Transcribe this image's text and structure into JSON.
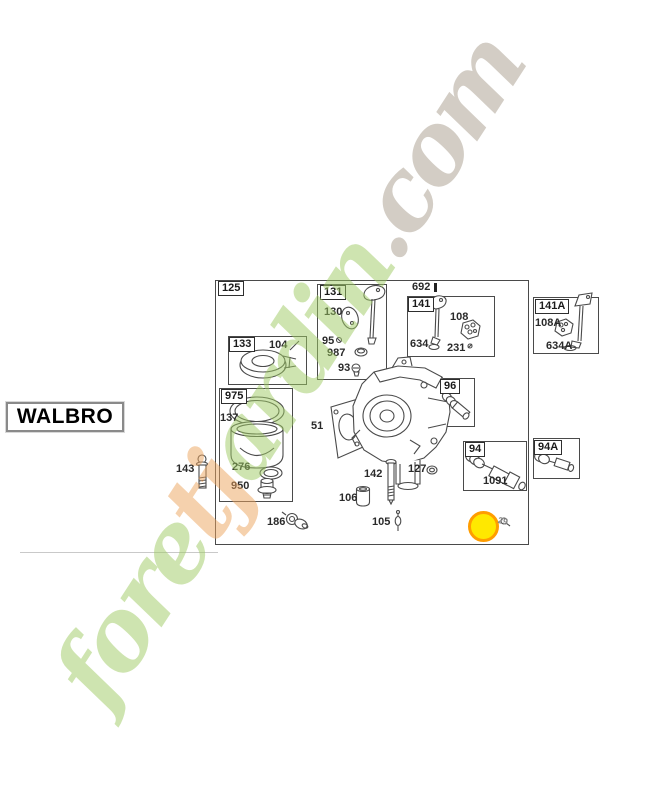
{
  "theme": {
    "green": "#9fcb63",
    "orange": "#eda45e",
    "tan": "#a89d8d",
    "highlight-fill": "#ffe800",
    "highlight-border": "#ff9d00",
    "line": "#4a4a4a"
  },
  "brand": {
    "text": "WALBRO"
  },
  "watermark": {
    "full_text": "foretjardin.com",
    "part1": "fore",
    "part2": "tj",
    "part3": "ardin",
    "suffix": ".com"
  },
  "diagram": {
    "group_labels": {
      "g125": "125",
      "g131": "131",
      "g141": "141",
      "g141A": "141A",
      "g133": "133",
      "g975": "975",
      "g96": "96",
      "g94": "94",
      "g94A": "94A"
    },
    "part_labels": {
      "l692": "692",
      "l130": "130",
      "l95": "95",
      "l987": "987",
      "l93": "93",
      "l634": "634",
      "l108": "108",
      "l231": "231",
      "l108A": "108A",
      "l634A": "634A",
      "l104": "104",
      "l137": "137",
      "l276": "276",
      "l950": "950",
      "l143": "143",
      "l51": "51",
      "l142": "142",
      "l127": "127",
      "l106": "106",
      "l105": "105",
      "l186": "186",
      "l1091": "1091",
      "l29": "29"
    }
  }
}
